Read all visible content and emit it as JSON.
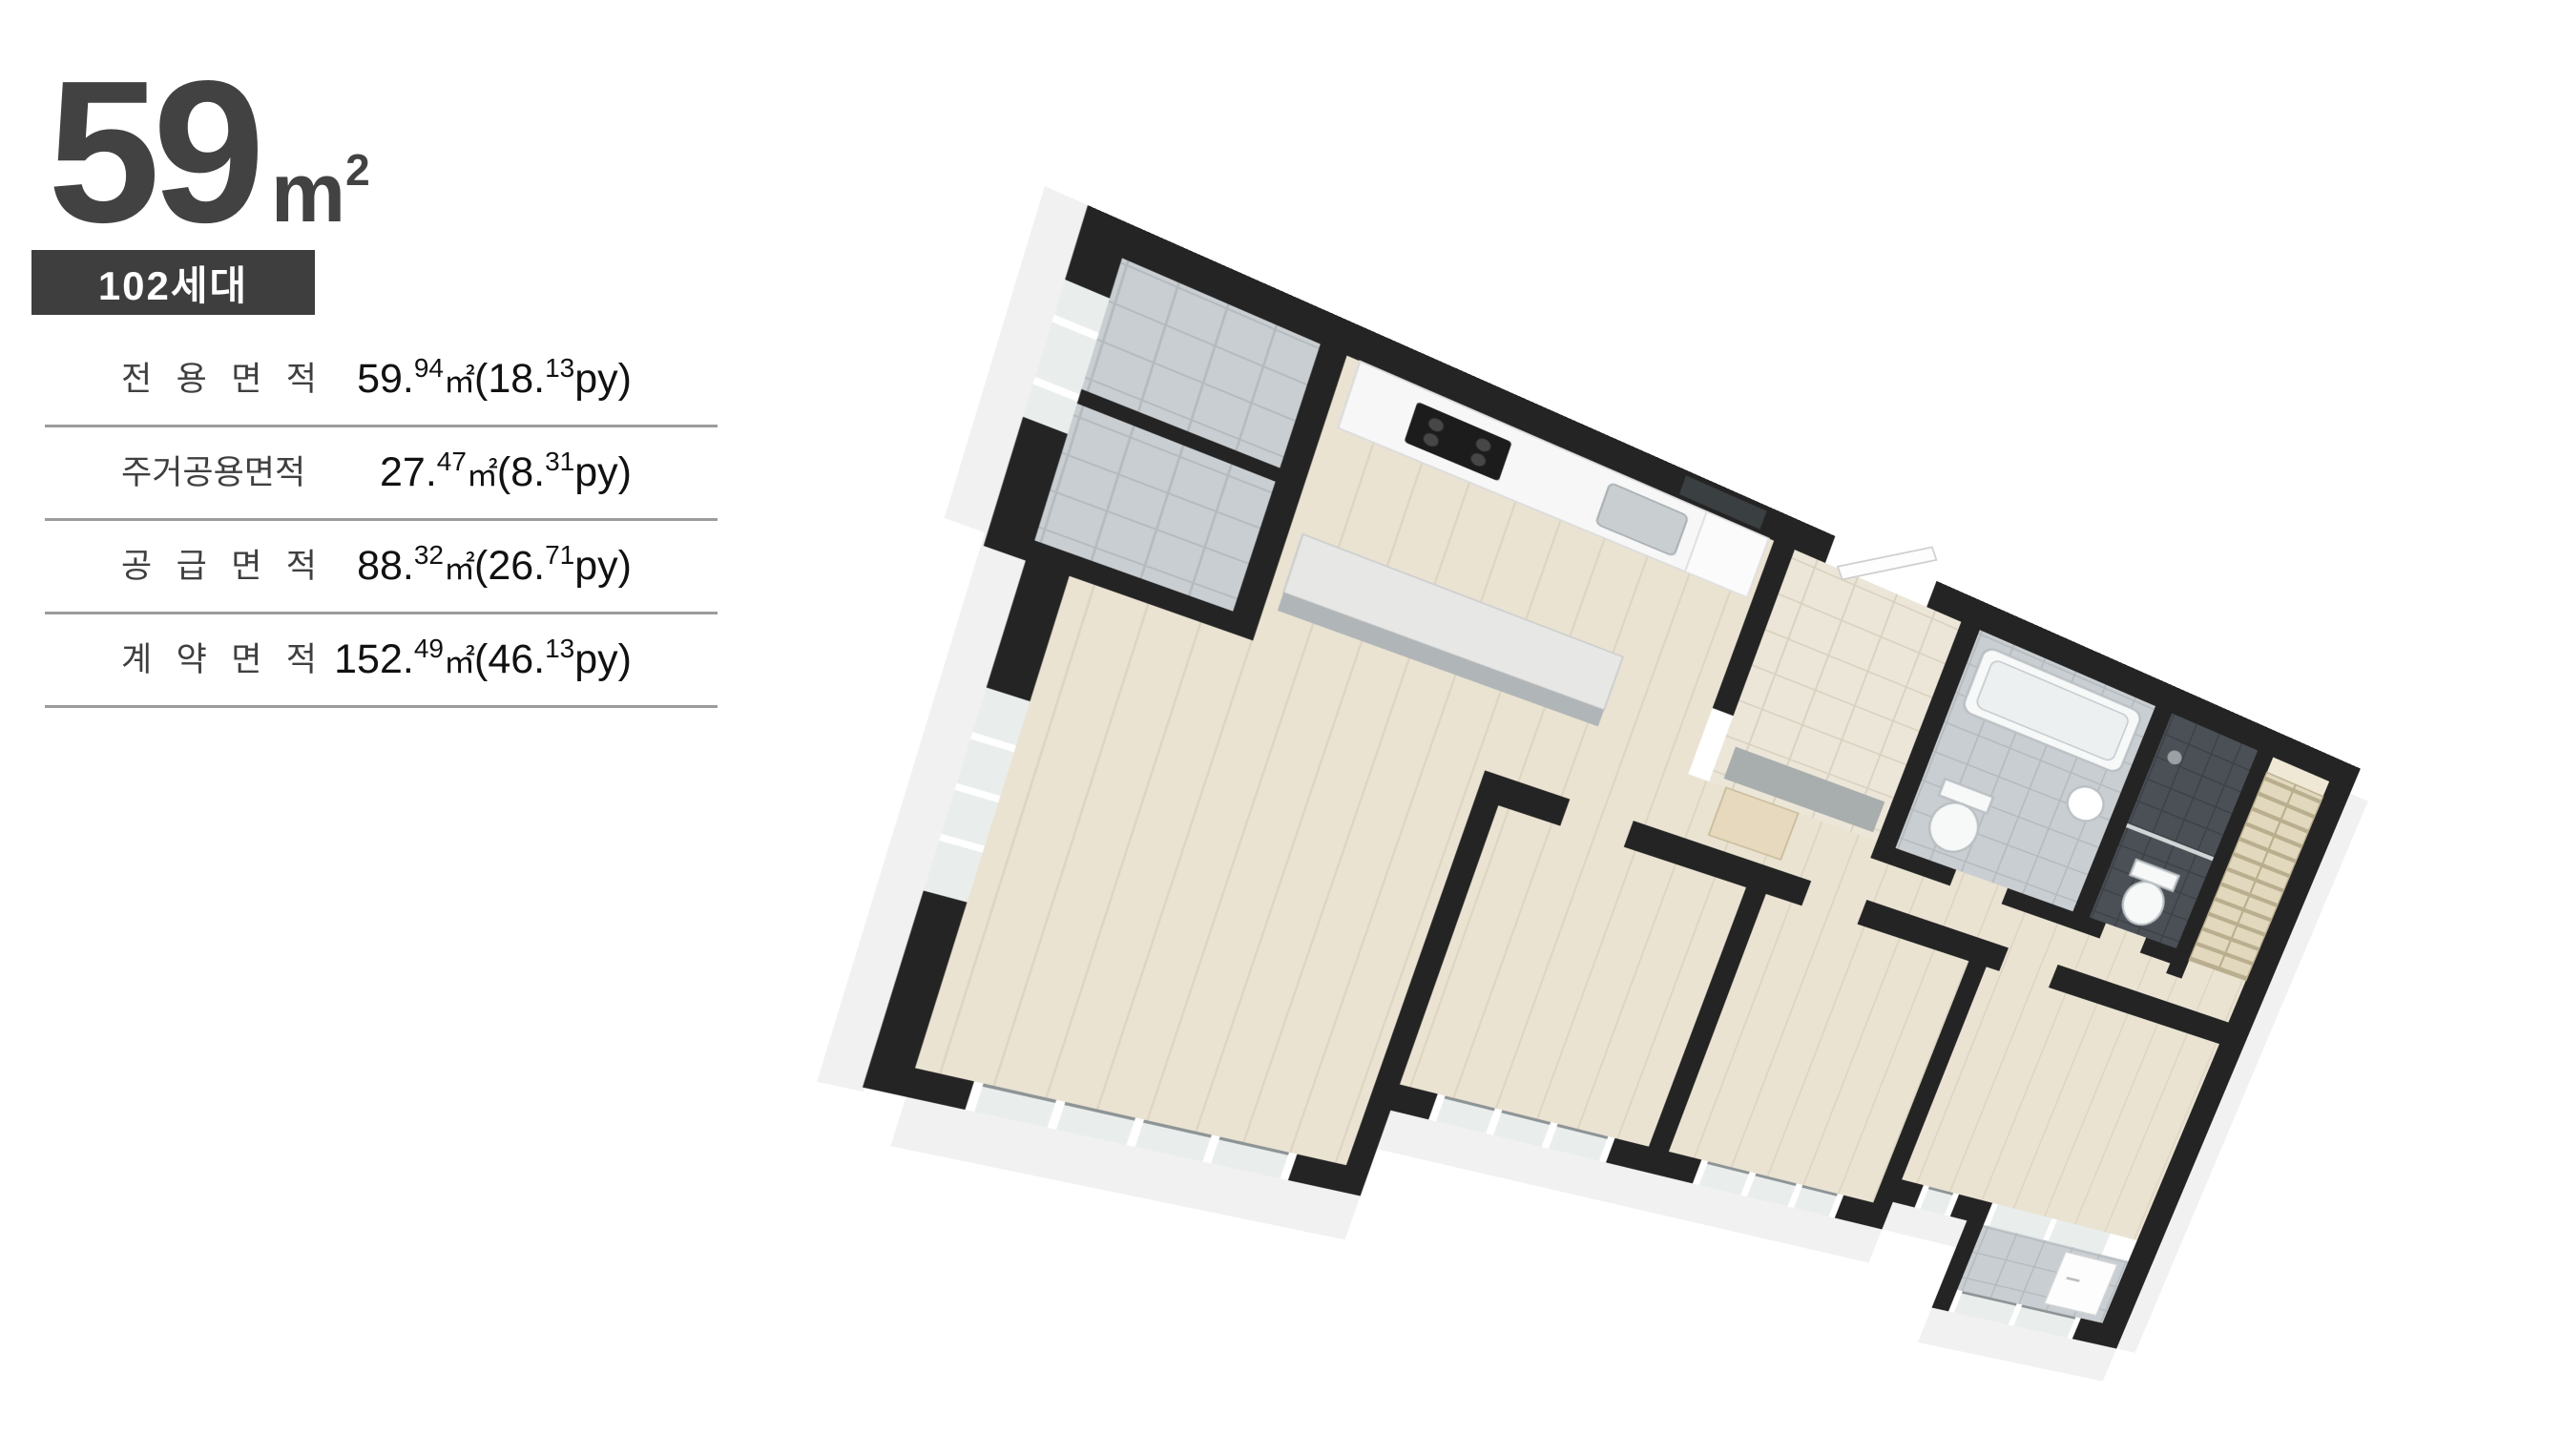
{
  "header": {
    "size_number": "59",
    "size_unit_base": "m",
    "size_unit_exp": "2",
    "badge": "102세대"
  },
  "area_table": {
    "unit_m2": "㎡",
    "py_suffix": "py)",
    "rows": [
      {
        "label": "전 용 면 적",
        "m": "59.",
        "m_sup": "94",
        "py": "(18.",
        "py_sup": "13"
      },
      {
        "label": "주거공용면적",
        "m": "27.",
        "m_sup": "47",
        "py": "(8.",
        "py_sup": "31"
      },
      {
        "label": "공 급 면 적",
        "m": "88.",
        "m_sup": "32",
        "py": "(26.",
        "py_sup": "71"
      },
      {
        "label": "계 약 면 적",
        "m": "152.",
        "m_sup": "49",
        "py": "(46.",
        "py_sup": "13"
      }
    ]
  },
  "floor_plan": {
    "colors": {
      "wall": "#242424",
      "wood": "#eae3d2",
      "wood_line": "#ddd5c1",
      "tile": "#c9ced2",
      "tile_line": "#b4babd",
      "tile_dark": "#4a5056",
      "tile_dark_line": "#3d4247",
      "entry": "#ece6d8",
      "entry_line": "#d9d1c0",
      "marble": "#e7e7e5",
      "marble_side": "#b0b5b7",
      "shelf": "#e2d8bd",
      "shelf_line": "#b9ae8e",
      "glass": "#e9eeed",
      "rail": "#8e9496",
      "mat": "#a8adad",
      "extrusion": "#f1f1f1",
      "fixture_stroke": "#b9bfc2"
    }
  }
}
